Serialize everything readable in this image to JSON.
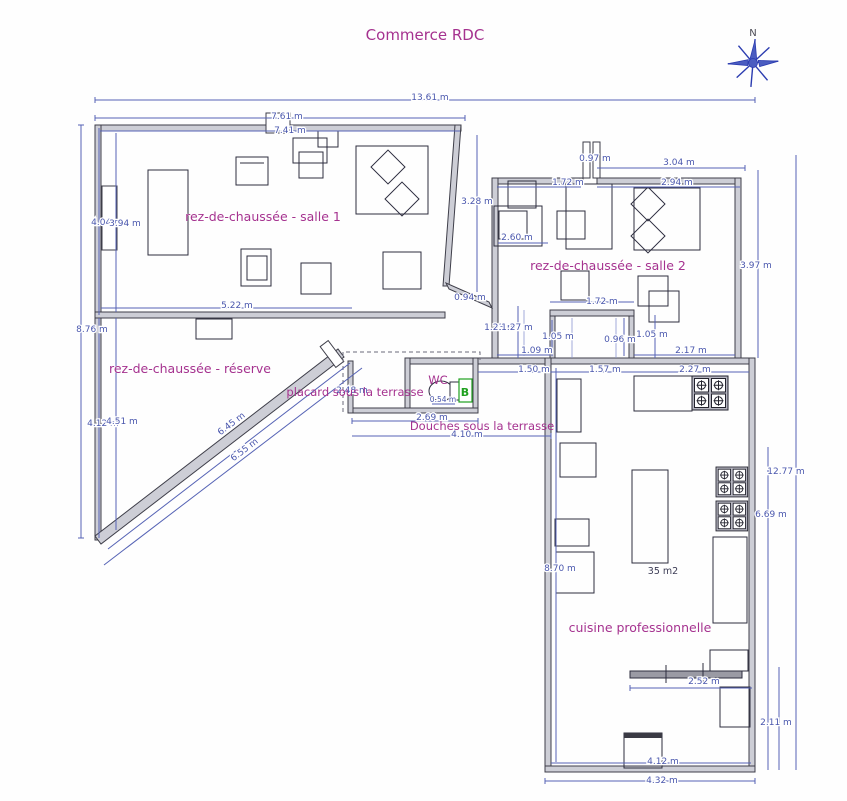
{
  "title": "Commerce RDC",
  "compass": {
    "north_label": "N"
  },
  "colors": {
    "room_label": "#a5328f",
    "dimension": "#4a57ad",
    "wall": "#3e3e49",
    "compass": "#2b3cb0",
    "boiler_green": "#1fa01f"
  },
  "rooms": {
    "salle1": "rez-de-chaussée - salle 1",
    "salle2": "rez-de-chaussée - salle 2",
    "reserve": "rez-de-chaussée - réserve",
    "placard": "placard sous la terrasse",
    "wc": "WC",
    "douches": "Douches sous la terrasse",
    "cuisine": "cuisine professionnelle",
    "cuisine_area": "35 m2",
    "boiler": "B"
  },
  "dims": {
    "top_total": "13.61 m",
    "top_outer": "7.61 m",
    "salle1_width": "7.41 m",
    "left_upper_a": "4.04 m",
    "left_upper_b": "3.94 m",
    "left_total": "8.76 m",
    "salle1_bottom": "5.22 m",
    "salle1_right_h": "3.28 m",
    "salle2_door": "0.97 m",
    "salle2_top_right": "3.04 m",
    "salle2_top_left": "1.72 m",
    "salle2_top_right_inner": "2.94 m",
    "salle2_desk": "2.60 m",
    "salle2_right_h": "3.97 m",
    "salle1_door": "0.94 m",
    "corridor_a": "1.23 m",
    "corridor_b": "1.27 m",
    "vestibule_top": "1.72 m",
    "vestibule_left": "1.05 m",
    "vestibule_inner": "0.96 m",
    "vestibule_right": "1.05 m",
    "passage_left": "1.09 m",
    "passage_right": "2.17 m",
    "douches_door": "1.50 m",
    "kitchen_top_left": "1.57 m",
    "kitchen_top_right": "2.27 m",
    "wc_width": "2.69 m",
    "douches_width": "4.10 m",
    "wc_fixture": "0.54 m",
    "placard_width": "2.48 m",
    "left_lower_a": "4.12 m",
    "left_lower_b": "4.51 m",
    "diag_inner": "6.45 m",
    "diag_outer": "6.55 m",
    "kitchen_left_h": "8.70 m",
    "right_total": "12.77 m",
    "kitchen_right_h": "6.69 m",
    "kitchen_counter": "2.52 m",
    "kitchen_right_lower": "2.11 m",
    "kitchen_bottom_inner": "4.12 m",
    "kitchen_bottom_outer": "4.32 m"
  }
}
